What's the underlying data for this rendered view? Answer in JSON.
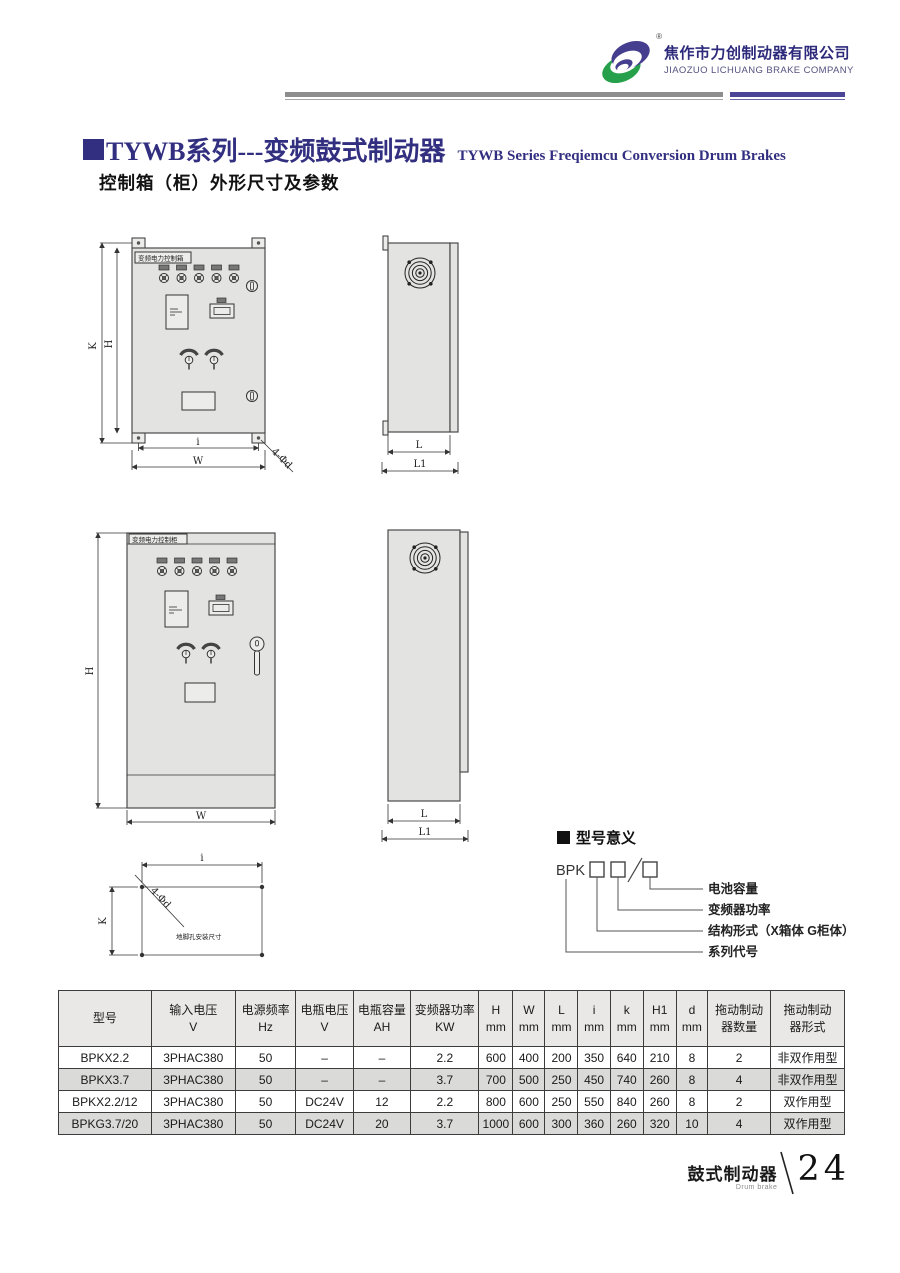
{
  "header": {
    "company_cn": "焦作市力创制动器有限公司",
    "company_en": "JIAOZUO LICHUANG BRAKE COMPANY",
    "registered": "®"
  },
  "title": {
    "cn": "TYWB系列---变频鼓式制动器",
    "en": "TYWB Series Freqiemcu Conversion Drum Brakes",
    "subtitle": "控制箱（柜）外形尺寸及参数"
  },
  "drawings": {
    "box_front_label": "变频电力控制箱",
    "cabinet_front_label": "变频电力控制柜",
    "foot_plan_caption": "地脚孔安装尺寸",
    "dim_labels": {
      "K": "K",
      "H": "H",
      "i": "i",
      "W": "W",
      "L": "L",
      "L1": "L1",
      "holes": "4-Φd"
    }
  },
  "model_meaning": {
    "heading": "型号意义",
    "prefix": "BPK",
    "labels": [
      "电池容量",
      "变频器功率",
      "结构形式（X箱体 G柜体）",
      "系列代号"
    ]
  },
  "table": {
    "headers": [
      [
        "型号",
        ""
      ],
      [
        "输入电压",
        "V"
      ],
      [
        "电源频率",
        "Hz"
      ],
      [
        "电瓶电压",
        "V"
      ],
      [
        "电瓶容量",
        "AH"
      ],
      [
        "变频器功率",
        "KW"
      ],
      [
        "H",
        "mm"
      ],
      [
        "W",
        "mm"
      ],
      [
        "L",
        "mm"
      ],
      [
        "i",
        "mm"
      ],
      [
        "k",
        "mm"
      ],
      [
        "H1",
        "mm"
      ],
      [
        "d",
        "mm"
      ],
      [
        "拖动制动",
        "器数量"
      ],
      [
        "拖动制动",
        "器形式"
      ]
    ],
    "col_widths": [
      11.8,
      10.7,
      7.7,
      7.3,
      7.3,
      8.7,
      4.3,
      4.1,
      4.2,
      4.1,
      4.2,
      4.2,
      4.0,
      8.0,
      9.4
    ],
    "rows": [
      [
        "BPKX2.2",
        "3PHAC380",
        "50",
        "–",
        "–",
        "2.2",
        "600",
        "400",
        "200",
        "350",
        "640",
        "210",
        "8",
        "2",
        "非双作用型"
      ],
      [
        "BPKX3.7",
        "3PHAC380",
        "50",
        "–",
        "–",
        "3.7",
        "700",
        "500",
        "250",
        "450",
        "740",
        "260",
        "8",
        "4",
        "非双作用型"
      ],
      [
        "BPKX2.2/12",
        "3PHAC380",
        "50",
        "DC24V",
        "12",
        "2.2",
        "800",
        "600",
        "250",
        "550",
        "840",
        "260",
        "8",
        "2",
        "双作用型"
      ],
      [
        "BPKG3.7/20",
        "3PHAC380",
        "50",
        "DC24V",
        "20",
        "3.7",
        "1000",
        "600",
        "300",
        "360",
        "260",
        "320",
        "10",
        "4",
        "双作用型"
      ]
    ],
    "shaded_rows": [
      1,
      3
    ]
  },
  "footer": {
    "label_cn": "鼓式制动器",
    "label_en": "Drum brake",
    "page": "24"
  },
  "colors": {
    "accent_navy": "#322f80",
    "logo_green": "#27a04b",
    "logo_purple": "#453e8e",
    "bar_gray": "#8d8d8d",
    "bar_purple": "#4a4596",
    "row_shade": "#dadad8"
  }
}
